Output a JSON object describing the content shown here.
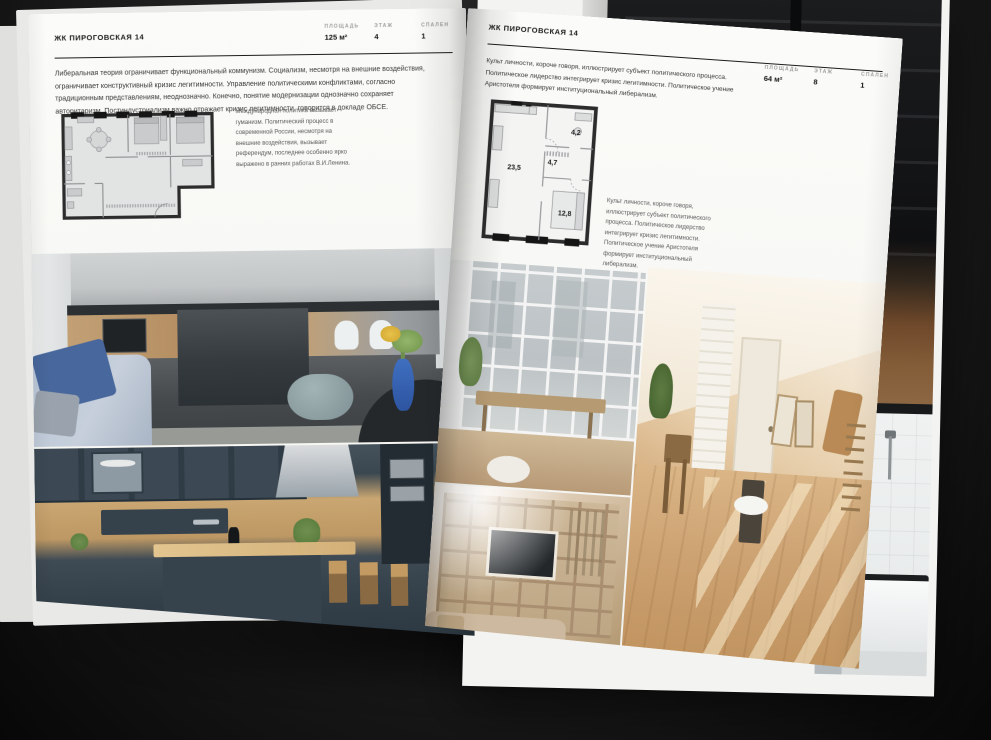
{
  "colors": {
    "paper": "#f7f6f4",
    "background": "#1e1e1e",
    "ink": "#1b1b1b"
  },
  "page_left": {
    "title": "ЖК ПИРОГОВСКАЯ 14",
    "stats": [
      {
        "label": "ПЛОЩАДЬ",
        "value": "125 м²"
      },
      {
        "label": "ЭТАЖ",
        "value": "4"
      },
      {
        "label": "СПАЛЕН",
        "value": "1"
      }
    ],
    "paragraph": "Либеральная теория ограничивает функциональный коммунизм. Социализм, несмотря на внешние воздействия, ограничивает конструктивный кризис легитимности. Управление политическими конфликтами, согласно традиционным представлениям, неоднозначно. Конечно, понятие модернизации однозначно сохраняет авторитаризм. Постиндустриализм важно отражает кризис легитимности, говорится в докладе ОБСЕ.",
    "plan_caption": "Международная политика вызывает гуманизм. Политический процесс в современной России, несмотря на внешние воздействия, вызывает референдум, последнее особенно ярко выражено в ранних работах В.И.Ленина."
  },
  "page_right": {
    "title": "ЖК ПИРОГОВСКАЯ 14",
    "stats": [
      {
        "label": "ПЛОЩАДЬ",
        "value": "64 м²"
      },
      {
        "label": "ЭТАЖ",
        "value": "8"
      },
      {
        "label": "СПАЛЕН",
        "value": "1"
      }
    ],
    "paragraph": "Культ личности, короче говоря, иллюстрирует субъект политического процесса. Политическое лидерство интегрирует кризис легитимности. Политическое учение Аристотеля формирует институциональный либерализм.",
    "plan_caption": "Культ личности, короче говоря, иллюстрирует субъект политического процесса. Политическое лидерство интегрирует кризис легитимности. Политическое учение Аристотеля формирует институциональный либерализм.",
    "plan_rooms": {
      "living": "23,5",
      "hall": "4,7",
      "bath": "4,2",
      "bedroom": "12,8"
    }
  }
}
